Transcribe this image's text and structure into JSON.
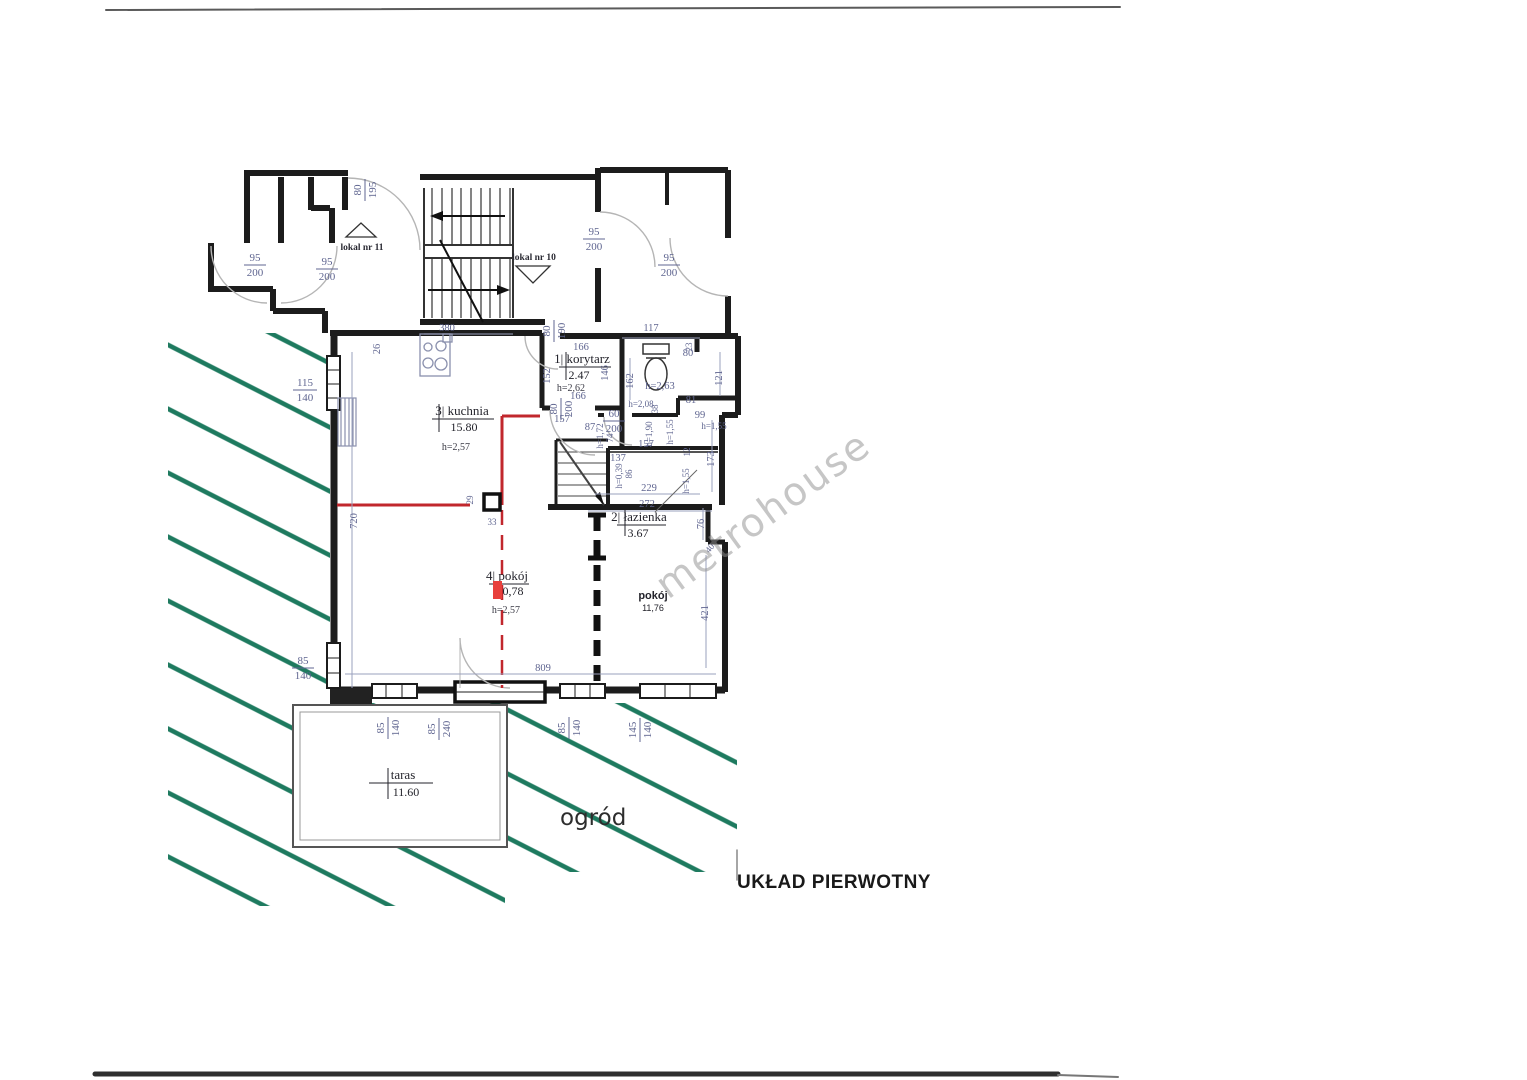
{
  "page": {
    "title": "UKŁAD PIERWOTNY",
    "watermark": "metrohouse",
    "garden": "ogród"
  },
  "units": {
    "lokal11": "lokal nr 11",
    "lokal10": "lokal nr 10"
  },
  "rooms": {
    "kuchnia": {
      "label": "3| kuchnia",
      "area": "15.80",
      "h": "h=2,57"
    },
    "korytarz": {
      "label": "1| korytarz",
      "area": "2.47",
      "h": "h=2,62"
    },
    "lazienka": {
      "label": "2| łazienka",
      "area": "3.67"
    },
    "pokoj4": {
      "label": "4| pokój",
      "area": "0,78",
      "h": "h=2,57"
    },
    "pokoj": {
      "label": "pokój",
      "area": "11,76"
    },
    "taras": {
      "label": "taras",
      "area": "11.60"
    }
  },
  "doors": [
    {
      "num": "80",
      "den": "195"
    },
    {
      "num": "95",
      "den": "200"
    },
    {
      "num": "95",
      "den": "200"
    },
    {
      "num": "95",
      "den": "200"
    },
    {
      "num": "95",
      "den": "200"
    },
    {
      "num": "80",
      "den": "190"
    },
    {
      "num": "115",
      "den": "140"
    },
    {
      "num": "80",
      "den": "200"
    },
    {
      "num": "60",
      "den": "200"
    },
    {
      "num": "85",
      "den": "140"
    },
    {
      "num": "85",
      "den": "140"
    },
    {
      "num": "85",
      "den": "240"
    },
    {
      "num": "85",
      "den": "140"
    },
    {
      "num": "145",
      "den": "140"
    }
  ],
  "dims": [
    "380",
    "117",
    "26",
    "166",
    "152",
    "146",
    "162",
    "80",
    "121",
    "81",
    "h=2,63",
    "166",
    "157",
    "h=2,08",
    "38",
    "87",
    "h=1,72",
    "74",
    "h=1,90",
    "h=1,55",
    "99",
    "h=1,55",
    "157",
    "137",
    "12",
    "173",
    "h=0,39",
    "86",
    "h=1,55",
    "229",
    "272",
    "76",
    "40",
    "421",
    "720",
    "809",
    "29",
    "33",
    "23"
  ],
  "colors": {
    "hatch_green": "#1e7a5f",
    "wall_black": "#1c1c1c",
    "annotation_red": "#c1272d",
    "dim_blue": "#5f6590"
  }
}
